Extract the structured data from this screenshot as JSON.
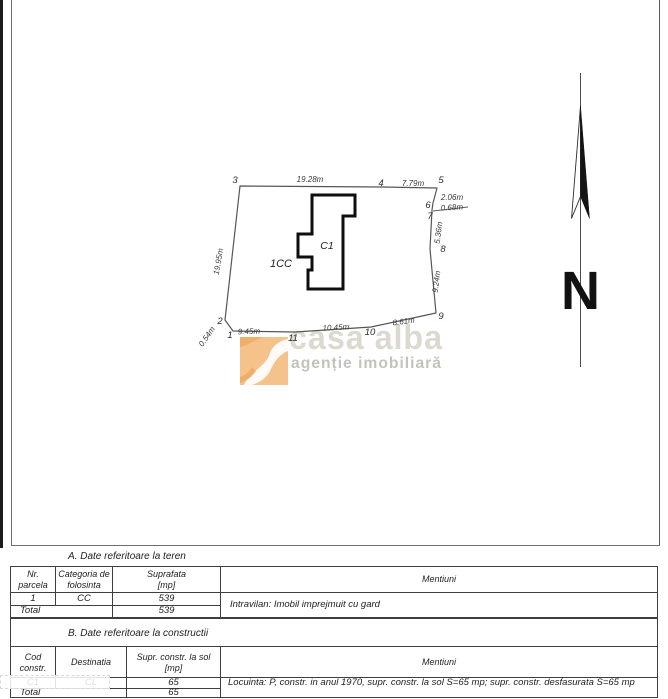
{
  "plan": {
    "parcel": {
      "points": [
        [
          240,
          186
        ],
        [
          382,
          187
        ],
        [
          437,
          188
        ],
        [
          433,
          203
        ],
        [
          432,
          210
        ],
        [
          430,
          249
        ],
        [
          436,
          313
        ],
        [
          371,
          327
        ],
        [
          295,
          332
        ],
        [
          233,
          331
        ],
        [
          225,
          320
        ]
      ],
      "stroke": "#565656"
    },
    "building": {
      "points": [
        [
          312,
          195
        ],
        [
          355,
          195
        ],
        [
          355,
          216
        ],
        [
          343,
          216
        ],
        [
          343,
          289
        ],
        [
          308,
          289
        ],
        [
          308,
          270
        ],
        [
          312,
          270
        ],
        [
          312,
          257
        ],
        [
          298,
          257
        ],
        [
          298,
          234
        ],
        [
          312,
          234
        ]
      ],
      "label": "C1",
      "label_pos": [
        327,
        249
      ]
    },
    "parcel_label": "1CC",
    "parcel_label_pos": [
      281,
      267
    ],
    "vertex_labels": [
      {
        "t": "1",
        "x": 230,
        "y": 338
      },
      {
        "t": "2",
        "x": 220,
        "y": 324
      },
      {
        "t": "3",
        "x": 235,
        "y": 183
      },
      {
        "t": "4",
        "x": 381,
        "y": 186
      },
      {
        "t": "5",
        "x": 441,
        "y": 183
      },
      {
        "t": "6",
        "x": 428,
        "y": 208
      },
      {
        "t": "7",
        "x": 430,
        "y": 219
      },
      {
        "t": "8",
        "x": 443,
        "y": 252
      },
      {
        "t": "9",
        "x": 441,
        "y": 319
      },
      {
        "t": "10",
        "x": 370,
        "y": 335
      },
      {
        "t": "11",
        "x": 293,
        "y": 341
      }
    ],
    "edge_labels": [
      {
        "t": "19.28m",
        "x": 310,
        "y": 182,
        "r": 0
      },
      {
        "t": "7.79m",
        "x": 413,
        "y": 186,
        "r": 0
      },
      {
        "t": "2.06m",
        "x": 452,
        "y": 200,
        "r": 0
      },
      {
        "t": "0.68m",
        "x": 452,
        "y": 210,
        "r": -3
      },
      {
        "t": "5.36m",
        "x": 441,
        "y": 233,
        "r": -83
      },
      {
        "t": "9.24m",
        "x": 439,
        "y": 282,
        "r": -83
      },
      {
        "t": "8.61m",
        "x": 404,
        "y": 324,
        "r": -8
      },
      {
        "t": "10.45m",
        "x": 336,
        "y": 330,
        "r": -3
      },
      {
        "t": "9.45m",
        "x": 249,
        "y": 334,
        "r": -2
      },
      {
        "t": "0.54m",
        "x": 209,
        "y": 338,
        "r": -55
      },
      {
        "t": "19.95m",
        "x": 221,
        "y": 262,
        "r": -80
      }
    ],
    "leader_line": {
      "x1": 433,
      "y1": 211,
      "x2": 468,
      "y2": 207
    }
  },
  "north_arrow": {
    "label": "N"
  },
  "watermark": {
    "line1": "casa alba",
    "line2": "agenție imobiliară",
    "logo_color": "#f6c28b",
    "logo_accent": "#efa75f"
  },
  "tables": {
    "a": {
      "title": "A. Date referitoare la teren",
      "headers": [
        "Nr.\nparcela",
        "Categoria de\nfolosinta",
        "Suprafata\n[mp]",
        "Mentiuni"
      ],
      "row": [
        "1",
        "CC",
        "539"
      ],
      "mentiuni": "Intravilan: Imobil imprejmuit cu gard",
      "total_label": "Total",
      "total_value": "539"
    },
    "b": {
      "title": "B. Date referitoare la constructii",
      "headers": [
        "Cod\nconstr.",
        "Destinatia",
        "Supr. constr. la sol\n[mp]",
        "Mentiuni"
      ],
      "row": [
        "C1",
        "CL",
        "65"
      ],
      "mentiuni": "Locuinta: P, constr. in anul 1970, supr. constr. la sol S=65 mp; supr. constr. desfasurata S=65 mp",
      "total_label": "Total",
      "total_value": "65"
    }
  }
}
